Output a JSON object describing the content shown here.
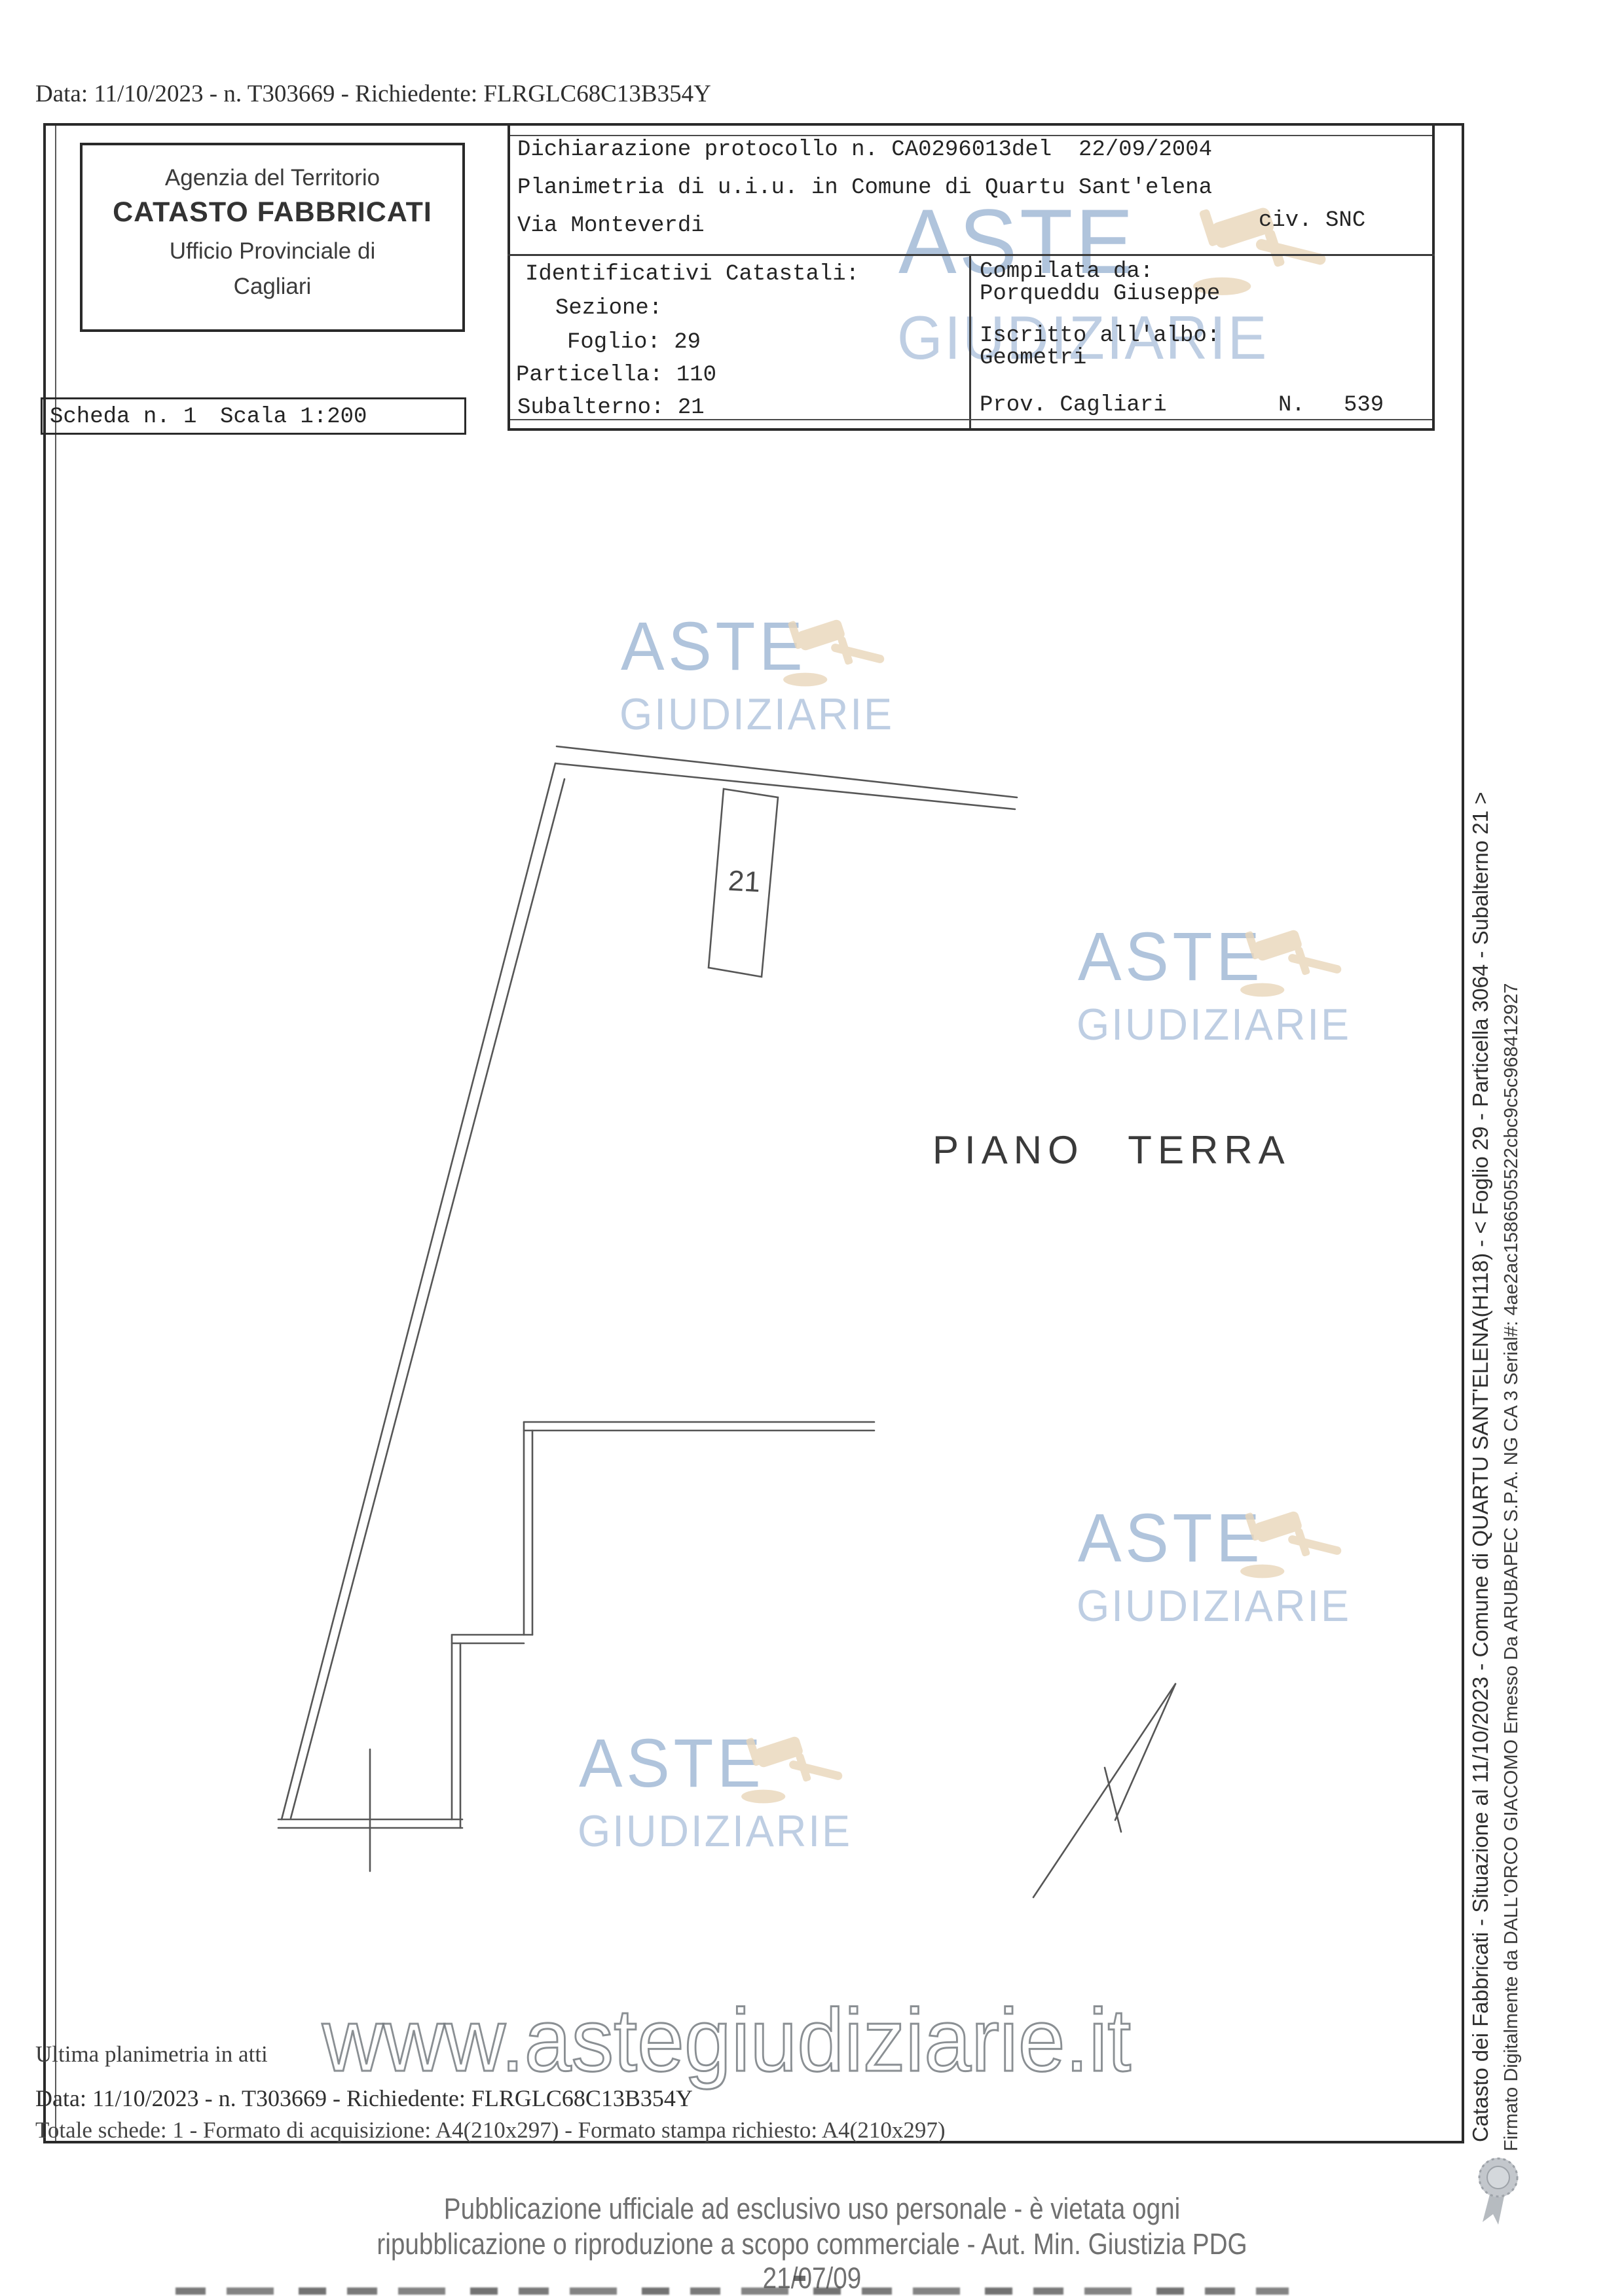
{
  "page": {
    "top_line": "Data: 11/10/2023 - n. T303669 - Richiedente: FLRGLC68C13B354Y"
  },
  "header": {
    "office": {
      "line1": "Agenzia del Territorio",
      "line2": "CATASTO FABBRICATI",
      "line3": "Ufficio Provinciale di",
      "line4": "Cagliari"
    },
    "scheda": {
      "label": "Scheda n. 1",
      "scale": "Scala 1:200"
    },
    "declaration": {
      "line1": "Dichiarazione protocollo n. CA0296013del  22/09/2004",
      "line2": "Planimetria di u.i.u. in Comune di Quartu Sant'elena",
      "street": "Via Monteverdi",
      "civ": "civ. SNC"
    },
    "identifiers": {
      "title": "Identificativi Catastali:",
      "sezione": "Sezione:",
      "foglio": "Foglio: 29",
      "particella": "Particella: 110",
      "subalterno": "Subalterno: 21"
    },
    "compiler": {
      "label": "Compilata da:",
      "name": "Porqueddu Giuseppe",
      "albo_label": "Iscritto all'albo:",
      "albo": "Geometri",
      "prov": "Prov. Cagliari",
      "n_label": "N.",
      "n_value": "539"
    }
  },
  "plan": {
    "room_label": "21",
    "floor_label": "PIANO TERRA"
  },
  "watermark": {
    "aste": "ASTE",
    "giudiziarie": "GIUDIZIARIE",
    "url": "www.astegiudiziarie.it",
    "color_blue": "#8ca8cc",
    "color_tan": "#e9d6ba"
  },
  "sidebar": {
    "line1": "Catasto dei Fabbricati - Situazione al 11/10/2023 - Comune di QUARTU SANT'ELENA(H118) - < Foglio 29 - Particella 3064 - Subalterno 21 >",
    "line2": "Firmato Digitalmente da DALL'ORCO GIACOMO Emesso Da ARUBAPEC S.P.A. NG CA 3 Serial#: 4ae2ac1586505522cbc9c5c968412927"
  },
  "footer": {
    "ultima": "Ultima planimetria in atti",
    "data_line": "Data: 11/10/2023 - n. T303669 - Richiedente: FLRGLC68C13B354Y",
    "totale": "Totale schede: 1 - Formato di acquisizione: A4(210x297) - Formato stampa richiesto: A4(210x297)",
    "legal1": "Pubblicazione ufficiale ad esclusivo uso personale - è vietata ogni",
    "legal2": "ripubblicazione o riproduzione a scopo commerciale - Aut. Min. Giustizia PDG 21/07/09"
  }
}
